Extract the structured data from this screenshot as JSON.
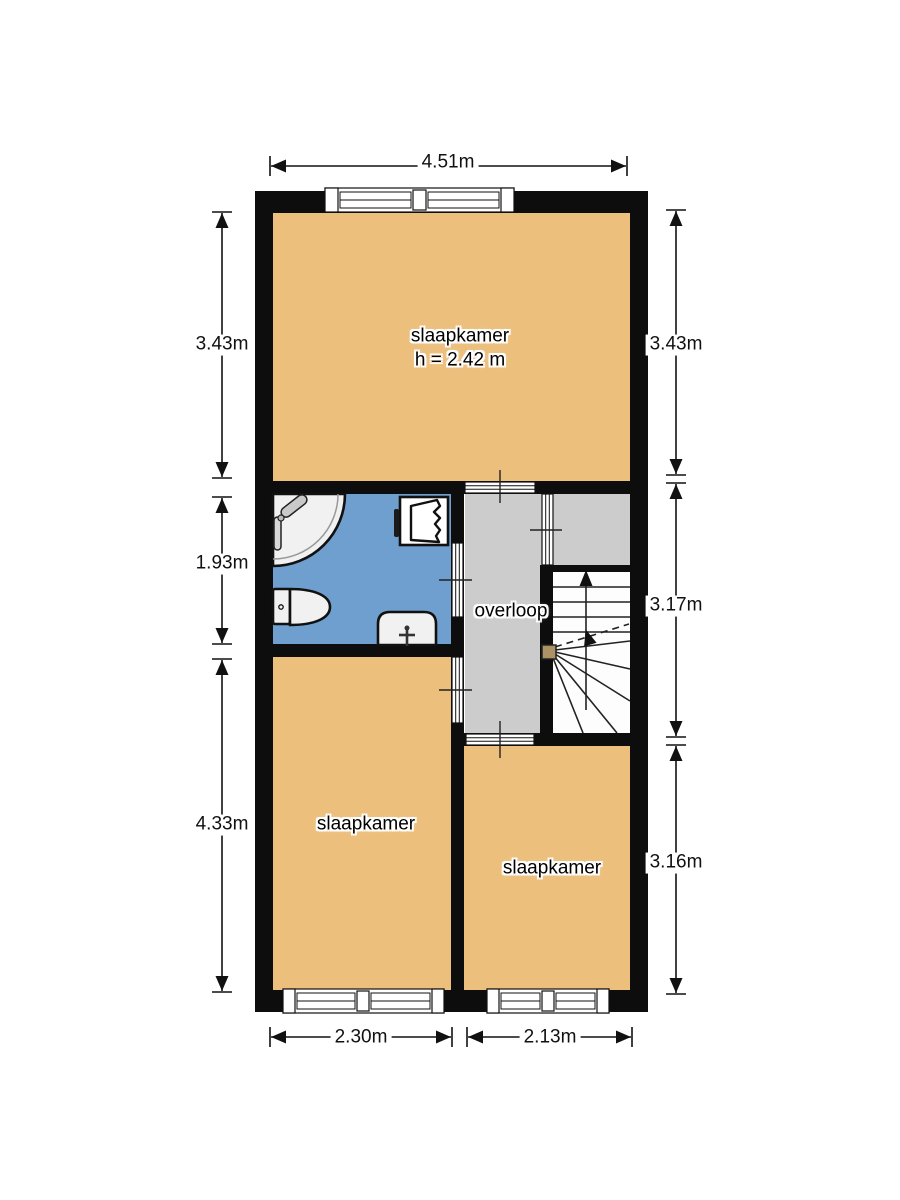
{
  "plan": {
    "rooms": {
      "bedroom_top": {
        "label": "slaapkamer",
        "height_note": "h = 2.42 m"
      },
      "landing": {
        "label": "overloop"
      },
      "bedroom_left": {
        "label": "slaapkamer"
      },
      "bedroom_right": {
        "label": "slaapkamer"
      }
    },
    "dimensions": {
      "top": "4.51m",
      "left_top": "3.43m",
      "left_middle": "1.93m",
      "left_bottom": "4.33m",
      "right_top": "3.43m",
      "right_middle": "3.17m",
      "right_bottom": "3.16m",
      "bottom_left": "2.30m",
      "bottom_right": "2.13m"
    },
    "colors": {
      "room_fill": "#ecbf7d",
      "bathroom_fill": "#6f9fce",
      "landing_fill": "#cccccc",
      "stair_fill": "#fdfdfd",
      "wall": "#0d0d0d",
      "newel_post": "#ad9266"
    }
  }
}
